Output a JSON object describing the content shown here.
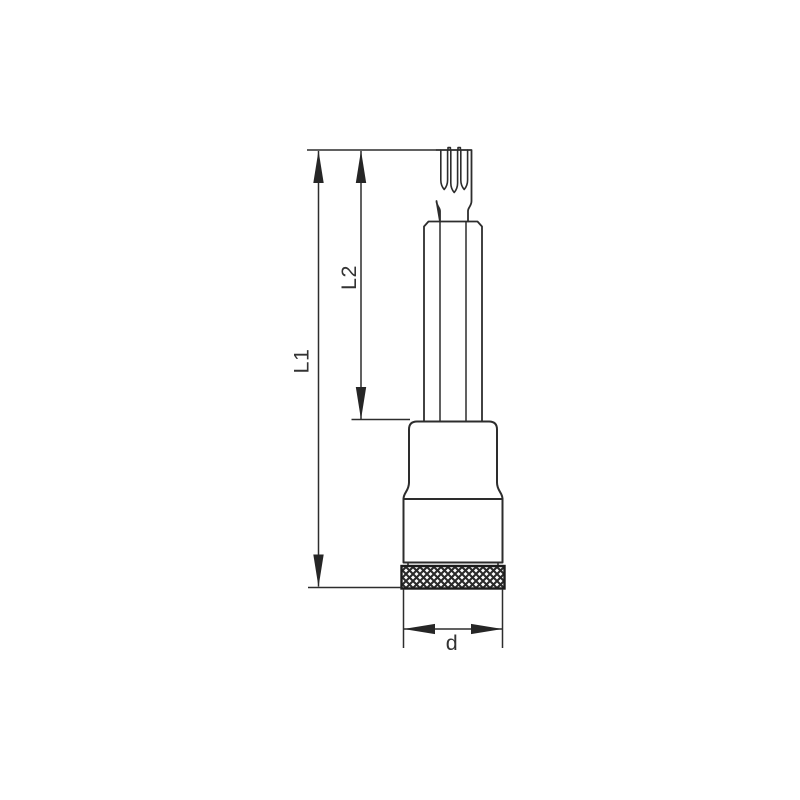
{
  "page": {
    "background": "#ffffff",
    "description": "Technical line drawing of a socket bit with spline tip and knurled ring, annotated with dimensions"
  },
  "labels": {
    "l1": "L1",
    "l2": "L2",
    "d": "d"
  },
  "colors": {
    "line": "#2d2d2d",
    "arrow": "#262626",
    "text": "#333333",
    "knurl_border": "#1c1c1c",
    "knurl_hatch": "#2a2a2a"
  }
}
